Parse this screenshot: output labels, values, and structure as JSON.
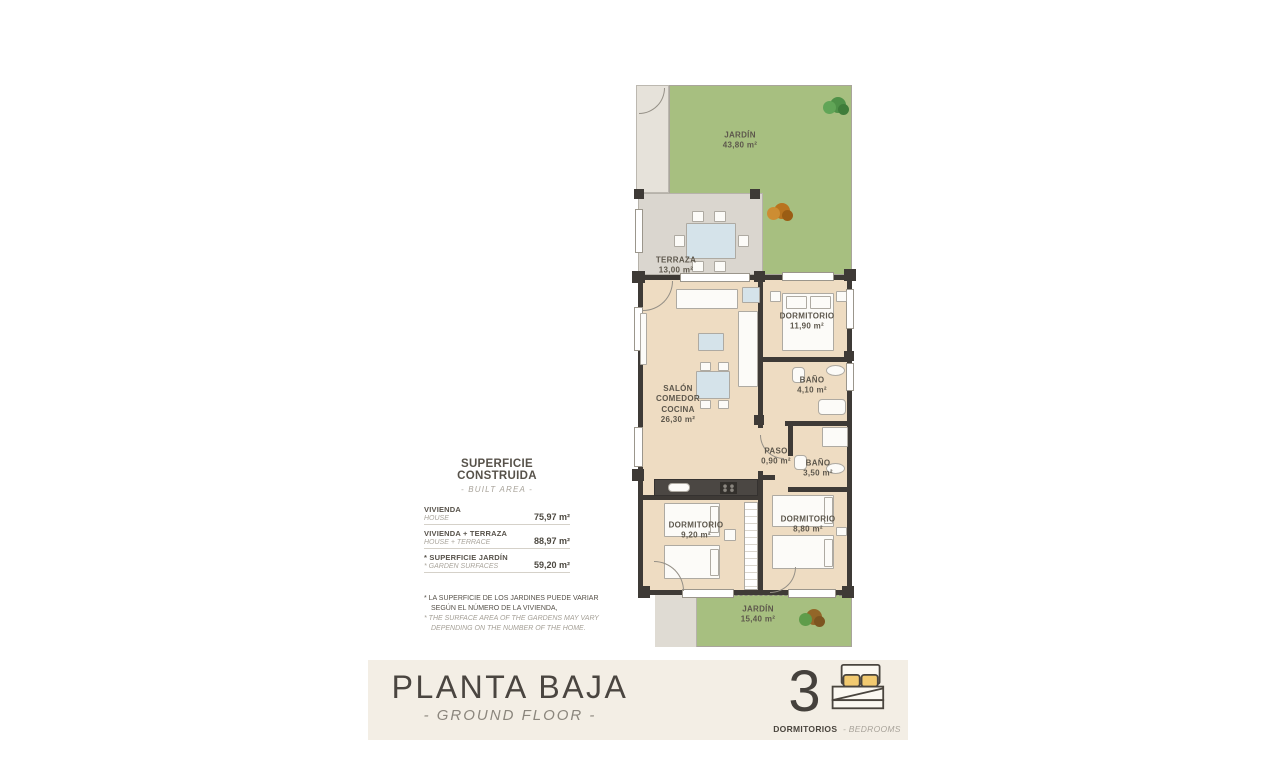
{
  "surface_table": {
    "title": "SUPERFICIE CONSTRUIDA",
    "subtitle": "- BUILT AREA -",
    "rows": [
      {
        "label_es": "VIVIENDA",
        "label_en": "HOUSE",
        "value": "75,97 m²"
      },
      {
        "label_es": "VIVIENDA + TERRAZA",
        "label_en": "HOUSE + TERRACE",
        "value": "88,97 m²"
      },
      {
        "label_es": "* SUPERFICIE JARDÍN",
        "label_en": "* GARDEN SURFACES",
        "value": "59,20 m²"
      }
    ],
    "footnote": {
      "es_line1": "* LA SUPERFICIE DE LOS JARDINES PUEDE VARIAR",
      "es_line2": "SEGÚN EL NÚMERO DE LA VIVIENDA,",
      "en_line1": "* THE SURFACE AREA OF THE GARDENS MAY VARY",
      "en_line2": "DEPENDING ON THE NUMBER OF THE HOME."
    }
  },
  "floorplan": {
    "jardin_top": {
      "name": "JARDÍN",
      "area": "43,80 m²"
    },
    "terraza": {
      "name": "TERRAZA",
      "area": "13,00 m²"
    },
    "salon": {
      "line1": "SALÓN",
      "line2": "COMEDOR",
      "line3": "COCINA",
      "area": "26,30 m²"
    },
    "dormitorio_principal": {
      "name": "DORMITORIO",
      "area": "11,90 m²"
    },
    "bano_1": {
      "name": "BAÑO",
      "area": "4,10 m²"
    },
    "paso": {
      "name": "PASO",
      "area": "0,90 m²"
    },
    "bano_2": {
      "name": "BAÑO",
      "area": "3,50 m²"
    },
    "dormitorio_2": {
      "name": "DORMITORIO",
      "area": "9,20 m²"
    },
    "dormitorio_3": {
      "name": "DORMITORIO",
      "area": "8,80 m²"
    },
    "jardin_bottom": {
      "name": "JARDÍN",
      "area": "15,40 m²"
    }
  },
  "footer": {
    "title": "PLANTA BAJA",
    "subtitle": "- GROUND FLOOR -",
    "bedrooms_count": "3",
    "bedrooms_label_es": "DORMITORIOS",
    "bedrooms_label_en": "- BEDROOMS"
  },
  "colors": {
    "garden_green": "#a7bf80",
    "terrace_grey": "#dad6cf",
    "floor_beige": "#eedcc2",
    "wall_dark": "#3e3a36",
    "band_cream": "#f3eee5",
    "pillow_yellow": "#f2ca70",
    "text_dark": "#57524a",
    "text_muted": "#a8a39a"
  }
}
